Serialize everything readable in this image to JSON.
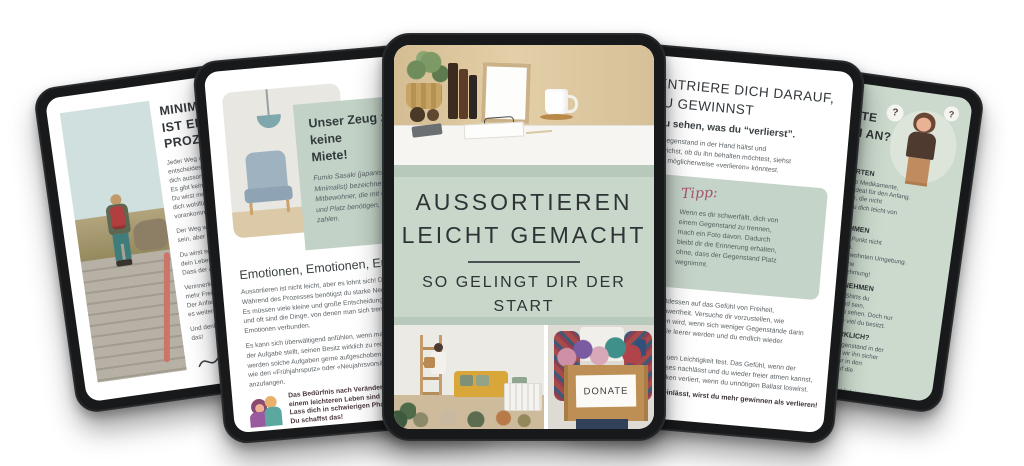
{
  "cover": {
    "title": "AUSSORTIEREN\nLEICHT GEMACHT",
    "subtitle": "SO GELINGT DIR DER\nSTART",
    "donate_label": "DONATE",
    "colors": {
      "sage": "#c8d7ca",
      "sage_dark": "#b6c9ba"
    }
  },
  "intro_page": {
    "heading": "MINIMALISMUS\nIST EIN\nPROZESS",
    "para1": "Jeder Weg ist einzigartig und du\nentscheidest ganz allein, wie du\ndich aussortieren möchtest.\nEs gibt kein richtig oder falsch.\nDu wirst merken, wie schnell du\ndich wohlfühlst und wie gut du\nvorankommst.",
    "para2": "Der Weg wird nicht immer leicht\nsein, aber er lohnt sich.",
    "para3": "Du wirst sehen, wie sehr sich\ndein Leben verändern wird.\nDass der Anfang schwer ist.",
    "para4": "Verinnerliche, dass du dadurch\nmehr Freiheit gewinnen wirst.\nDer Anfang ist gemacht, sodass\nes weitergehen kann.",
    "para5": "Und denk daran: Du schaffst das!"
  },
  "emotions_page": {
    "card_title": "Unser Zeug zahlt keine\nMiete!",
    "card_quote": "Fumio Sasaki (japanischer\nMinimalist) bezeichnet Dinge als\nMitbewohner, die mit uns wohnen\nund Platz benötigen, aber keine Miete\nzahlen.",
    "heading": "Emotionen, Emotionen, Emotionen",
    "para1": "Aussortieren ist nicht leicht, aber es lohnt sich! Denn:\nWährend des Prozesses benötigst du starke Nerven.\nEs müssen viele kleine und große Entscheidungen her\nund oft sind die Dinge, von denen man sich trennt, mit\nEmotionen verbunden.",
    "para2": "Es kann sich überwältigend anfühlen, wenn man sich\nder Aufgabe stellt, seinen Besitz wirklich zu reduzieren. Oft\nwerden solche Aufgaben gerne aufgeschoben und auf Anlässe\nwie den «Frühjahrsputz» oder «Neujahrsvorsätze» gewartet, um\nanzufangen.",
    "callout": "Das Bedürfnis nach Veränderung und der Wunsch nach\neinem leichteren Leben sind nicht umsonst da.\nLass dich in schwierigen Phasen nicht entmutigen.\nDu schaffst das!"
  },
  "gains_page": {
    "heading": "KONZENTRIERE DICH DARAUF,\nWAS DU GEWINNST",
    "subheading": "Statt nur zu sehen, was du “verlierst”.",
    "para1": "Wenn du einen Gegenstand in der Hand hältst und\ndir den Kopf zerbrichst, ob du ihn behalten möchtest, siehst\ndu oft nur, was du möglicherweise «verlieren» könntest.",
    "tipp_label": "Tipp:",
    "tipp_text": "Wenn es dir schwerfällt, dich von\neinem Gegenstand zu trennen,\nmach ein Foto davon. Dadurch\nbleibt dir die Erinnerung erhalten,\nohne, dass der Gegenstand Platz\nwegnimmt.",
    "para2": "Konzentriere dich stattdessen auf das Gefühl von Freiheit,\nOrdnung und Unbeschwertheit. Versuche dir vorzustellen, wie\ndein Zuhause aussehen wird, wenn sich weniger Gegenstände darin\nbefinden, wie die Regale leerer werden und du endlich wieder\nPlatz hast.",
    "para3": "Halte das Gefühl der neuen Leichtigkeit fest. Das Gefühl, wenn der\nDruck des vollen Zuhauses nachlässt und du wieder freier atmen kannst,\nweil alles seinen Schrecken verliert, wenn du unnötigen Ballast loswirst.",
    "bold_line": "Wenn du dich darauf einlässt, wirst du mehr gewinnen als verlieren!"
  },
  "steps_page": {
    "heading": "ERSTE SCHRITTE\nWIE FANGE ICH AN?",
    "question_mark": "?",
    "sections": [
      {
        "title": "MIT LEICHTEN DINGEN STARTEN",
        "text": "Kaputte Gegenstände, abgelaufene Medikamente,\nangeschlagene Kaffeetassen sind ideal für den Anfang.\nKonzentriere dich auf Gegenstände, die nicht\nemotional aufgeladen sind, damit du dich leicht von\nihnen trennen kannst."
      },
      {
        "title": "ALLES AUS DEM REGAL NEHMEN",
        "text": "Wirklich alles! Es ist wichtig, diesen Punkt nicht\naus Bequemlichkeit zu überspringen.\nNimm die Gegenstände aus ihrer gewohnten Umgebung.\nDas bringt Bewegung in festgefahrene\nStrukturen und verändert die Wahrnehmung!"
      },
      {
        "title": "GLEICHE DINGE ZUSAMMENNEHMEN",
        "text": "Weißt du, wie viele Socken, Stifte, T-Shirts du\nwirklich besitzt? Es kann erschreckend sein,\nalles gesammelt auf einem Haufen zu sehen. Doch nur\nso bekommst du ein Gefühl dafür, wie viel du besitzt."
      },
      {
        "title_pre": "BRAUCHE ICH DAS ",
        "title_underline": "JETZT",
        "title_post": " WIRKLICH?",
        "text": "Oft sind wir der Meinung, dass ein Gegenstand in der\nZukunft noch nützlich sein könnte und wir ihn sicher\nbrauchen werden. Doch das stimmt nur in den\nseltensten Fällen. Konzentriere dich auf die\nGegenwart."
      }
    ],
    "closing": "Stelle dir die Frage: Brauche ich das wirklich in meiner\naktuellen Situation? Und sei bitte schonungslos."
  }
}
